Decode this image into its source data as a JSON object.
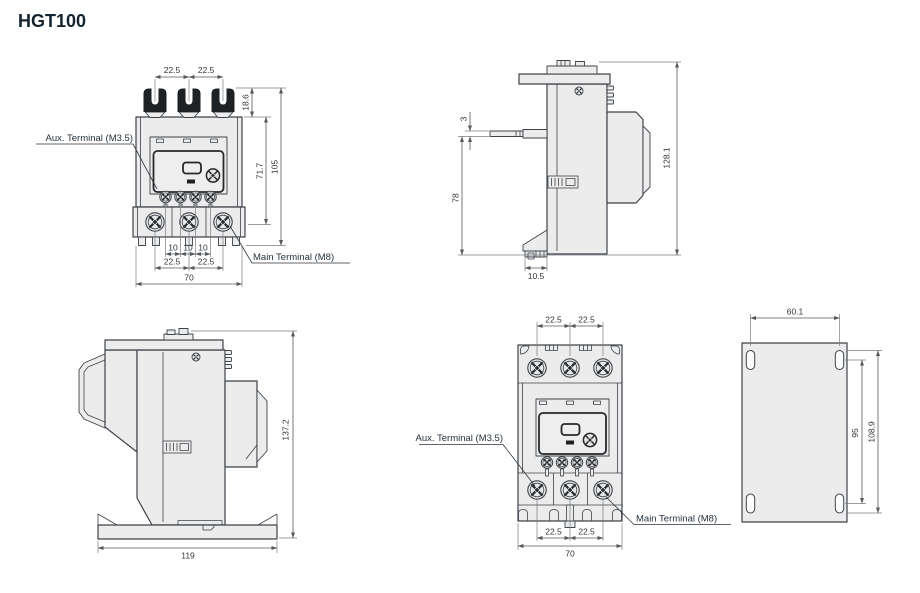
{
  "title": "HGT100",
  "colors": {
    "part_fill": "#ececec",
    "outline": "#3d4349",
    "dark_terminal": "#1f2224",
    "title_text": "#132430"
  },
  "callouts": {
    "aux": "Aux. Terminal (M3.5)",
    "main": "Main Terminal (M8)"
  },
  "front_view": {
    "top_pitch_left": "22.5",
    "top_pitch_right": "22.5",
    "terminal_height": "18.6",
    "body_height": "71.7",
    "overall_height": "105",
    "aux_pitch_1": "10",
    "aux_pitch_2": "10",
    "aux_pitch_3": "10",
    "main_pitch_left": "22.5",
    "main_pitch_right": "22.5",
    "overall_width": "70"
  },
  "side_view": {
    "pin_thickness": "3",
    "pin_height": "78",
    "overall_height": "128.1",
    "clip_width": "10.5"
  },
  "side_view_mounted": {
    "overall_height": "137.2",
    "base_width": "119"
  },
  "front_view_mounted": {
    "top_pitch_left": "22.5",
    "top_pitch_right": "22.5",
    "main_pitch_left": "22.5",
    "main_pitch_right": "22.5",
    "overall_width": "70"
  },
  "plate_view": {
    "hole_pitch_width": "60.1",
    "hole_pitch_height": "95",
    "hole_span_height": "108.9"
  }
}
